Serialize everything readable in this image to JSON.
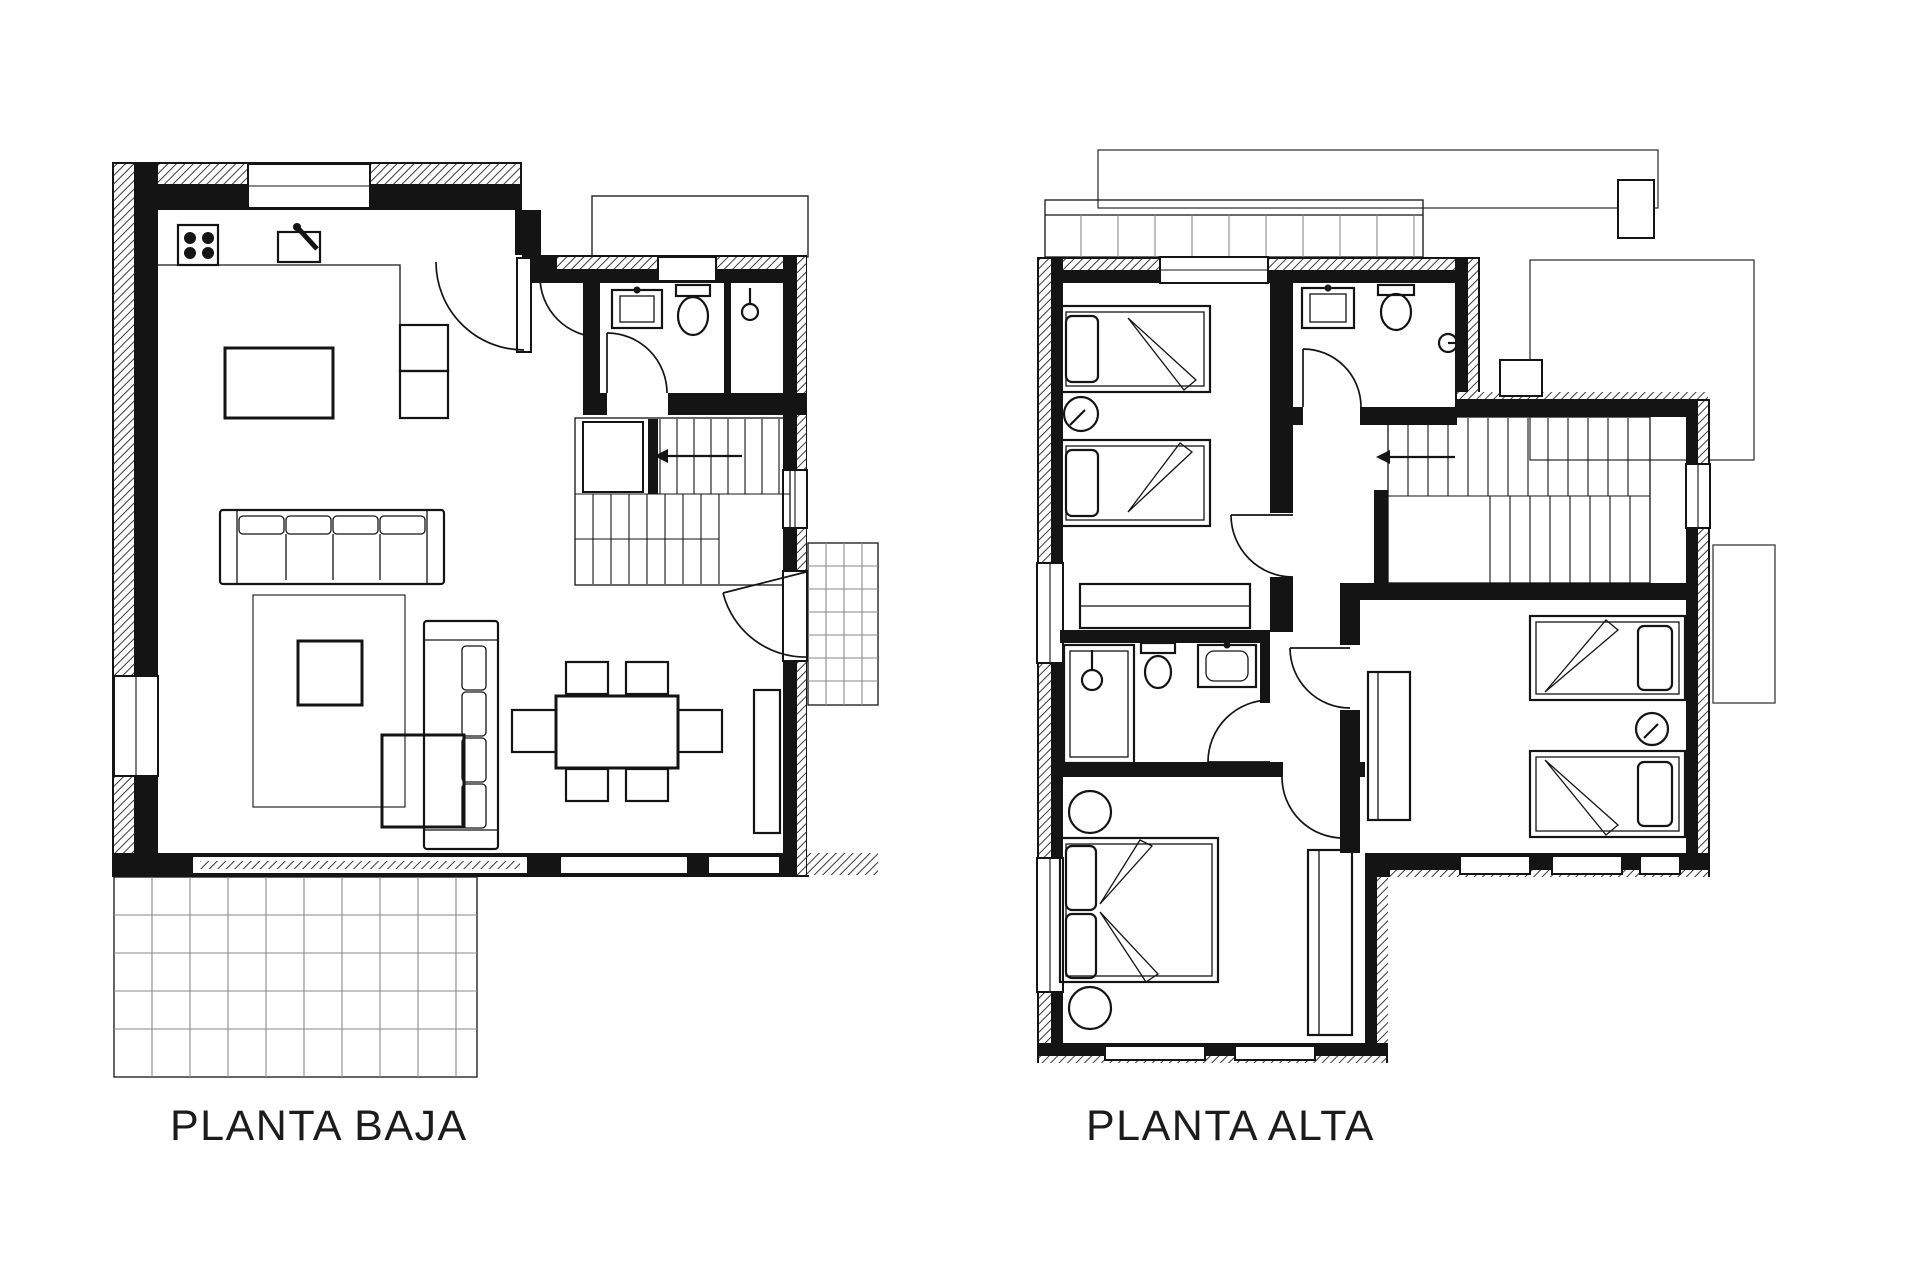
{
  "sheet": {
    "background": "#ffffff",
    "ink": "#141414",
    "plans": [
      {
        "id": "planta-baja",
        "label": "PLANTA BAJA",
        "symbols": [
          "stove-icon",
          "kitchen-sink-icon",
          "kitchen-island",
          "sofa-icon",
          "rug",
          "coffee-table",
          "side-table",
          "dining-table-icon",
          "chair-icon",
          "tv-bench",
          "stairs-icon",
          "stairs-arrow-icon",
          "bathroom-sink-icon",
          "toilet-icon",
          "shower-icon",
          "door-arc-icon",
          "window",
          "terrace-grid",
          "porch-grid",
          "roof-outline"
        ]
      },
      {
        "id": "planta-alta",
        "label": "PLANTA ALTA",
        "symbols": [
          "single-bed-icon",
          "double-bed-icon",
          "pillow",
          "lamp-icon",
          "nightstand-icon",
          "wardrobe-icon",
          "bathroom-sink-icon",
          "toilet-icon",
          "shower-icon",
          "stairs-icon",
          "stairs-arrow-icon",
          "door-arc-icon",
          "window",
          "balcony-grid",
          "roof-outline",
          "chimney"
        ]
      }
    ]
  }
}
